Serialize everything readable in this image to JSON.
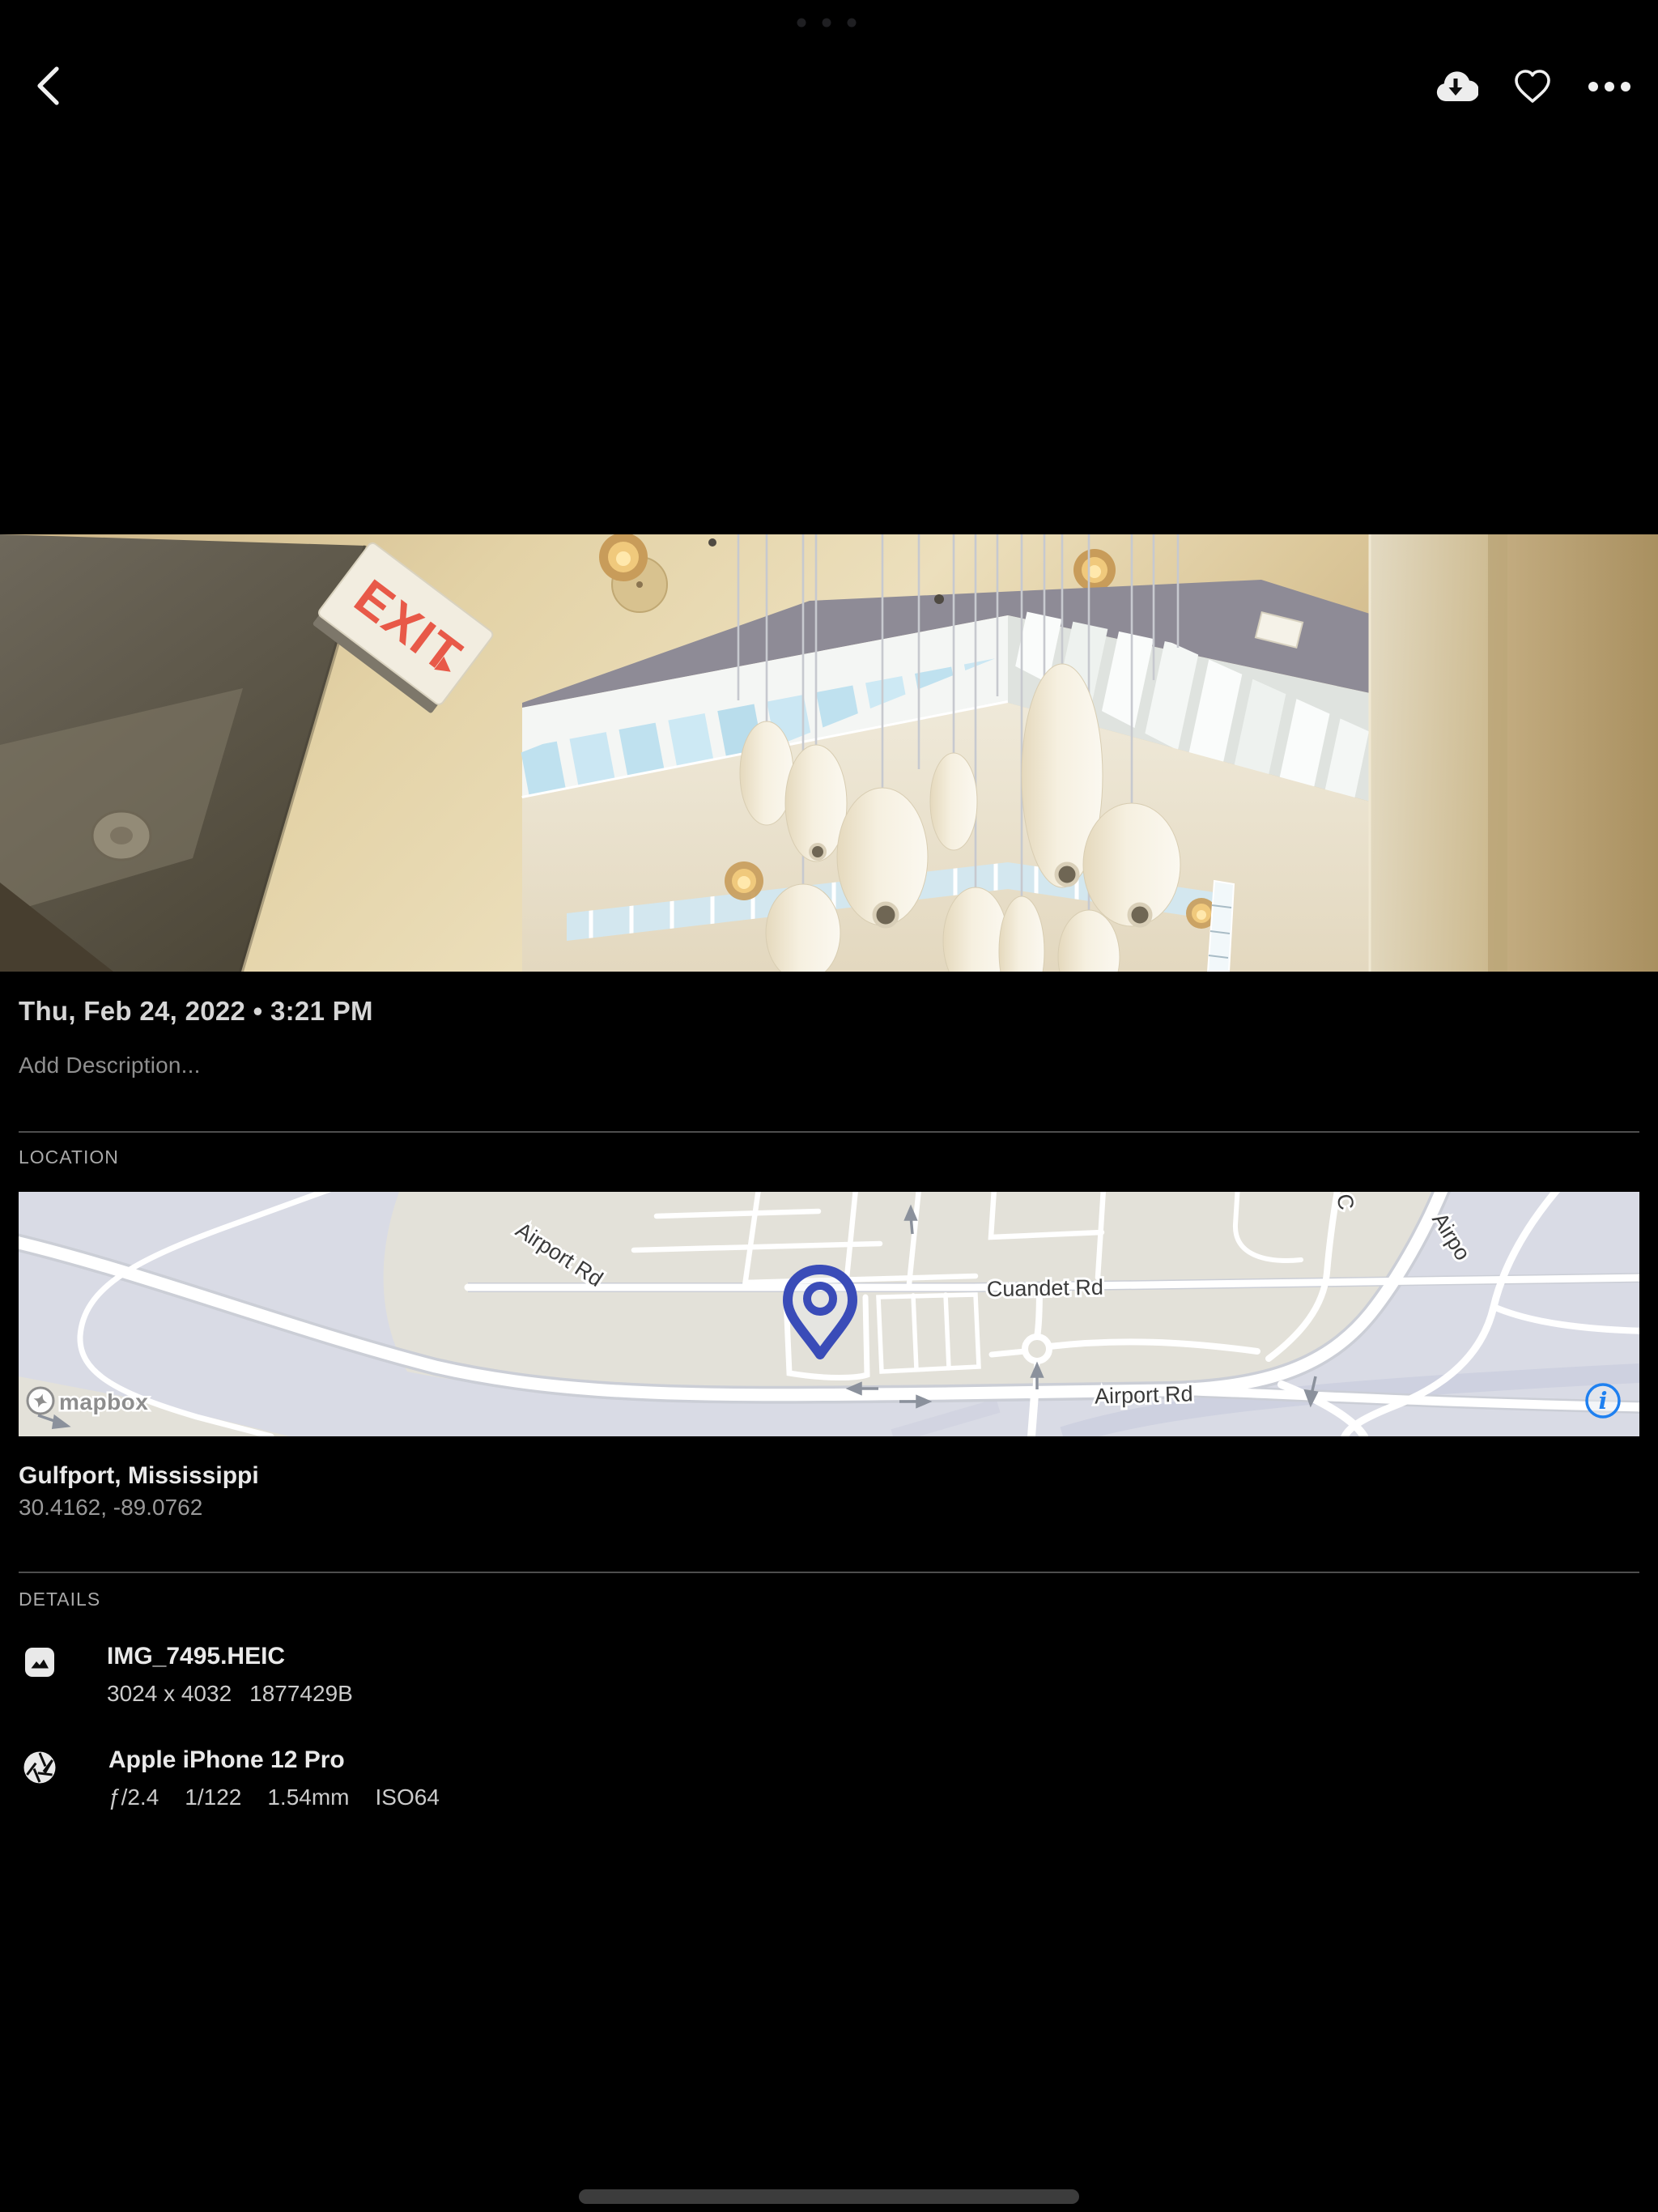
{
  "status_bar": {
    "multitask_indicator_icon": "ellipsis-dots"
  },
  "top_bar": {
    "back_icon": "chevron-left",
    "download_icon": "cloud-download",
    "favorite_icon": "heart-outline",
    "more_icon": "three-dots-menu"
  },
  "photo": {
    "exit_sign_text": "EXIT"
  },
  "metadata_panel": {
    "datetime": "Thu, Feb 24, 2022 • 3:21 PM",
    "description_placeholder": "Add Description...",
    "location": {
      "heading": "LOCATION",
      "place": "Gulfport, Mississippi",
      "coordinates": "30.4162, -89.0762",
      "map": {
        "road_labels": {
          "airport_rd_upper": "Airport Rd",
          "cuandet_rd": "Cuandet Rd",
          "airport_rd_lower": "Airport Rd",
          "airport_rd_right_partial": "Airpo",
          "c_road_partial": "C"
        },
        "attribution": "mapbox",
        "info_icon": "info-circle",
        "colors": {
          "land": "#d9dbe5",
          "built_area": "#e3e1d9",
          "road": "#ffffff",
          "pin": "#3a4cb8",
          "info_blue": "#1f80f0"
        }
      }
    },
    "details": {
      "heading": "DETAILS",
      "file": {
        "icon": "image-file",
        "name": "IMG_7495.HEIC",
        "dimensions": "3024 x 4032",
        "size_bytes": "1877429B"
      },
      "camera": {
        "icon": "aperture",
        "name": "Apple iPhone 12 Pro",
        "aperture": "ƒ/2.4",
        "shutter_speed": "1/122",
        "focal_length": "1.54mm",
        "iso": "ISO64"
      }
    }
  },
  "home_indicator_icon": "home-indicator-bar"
}
